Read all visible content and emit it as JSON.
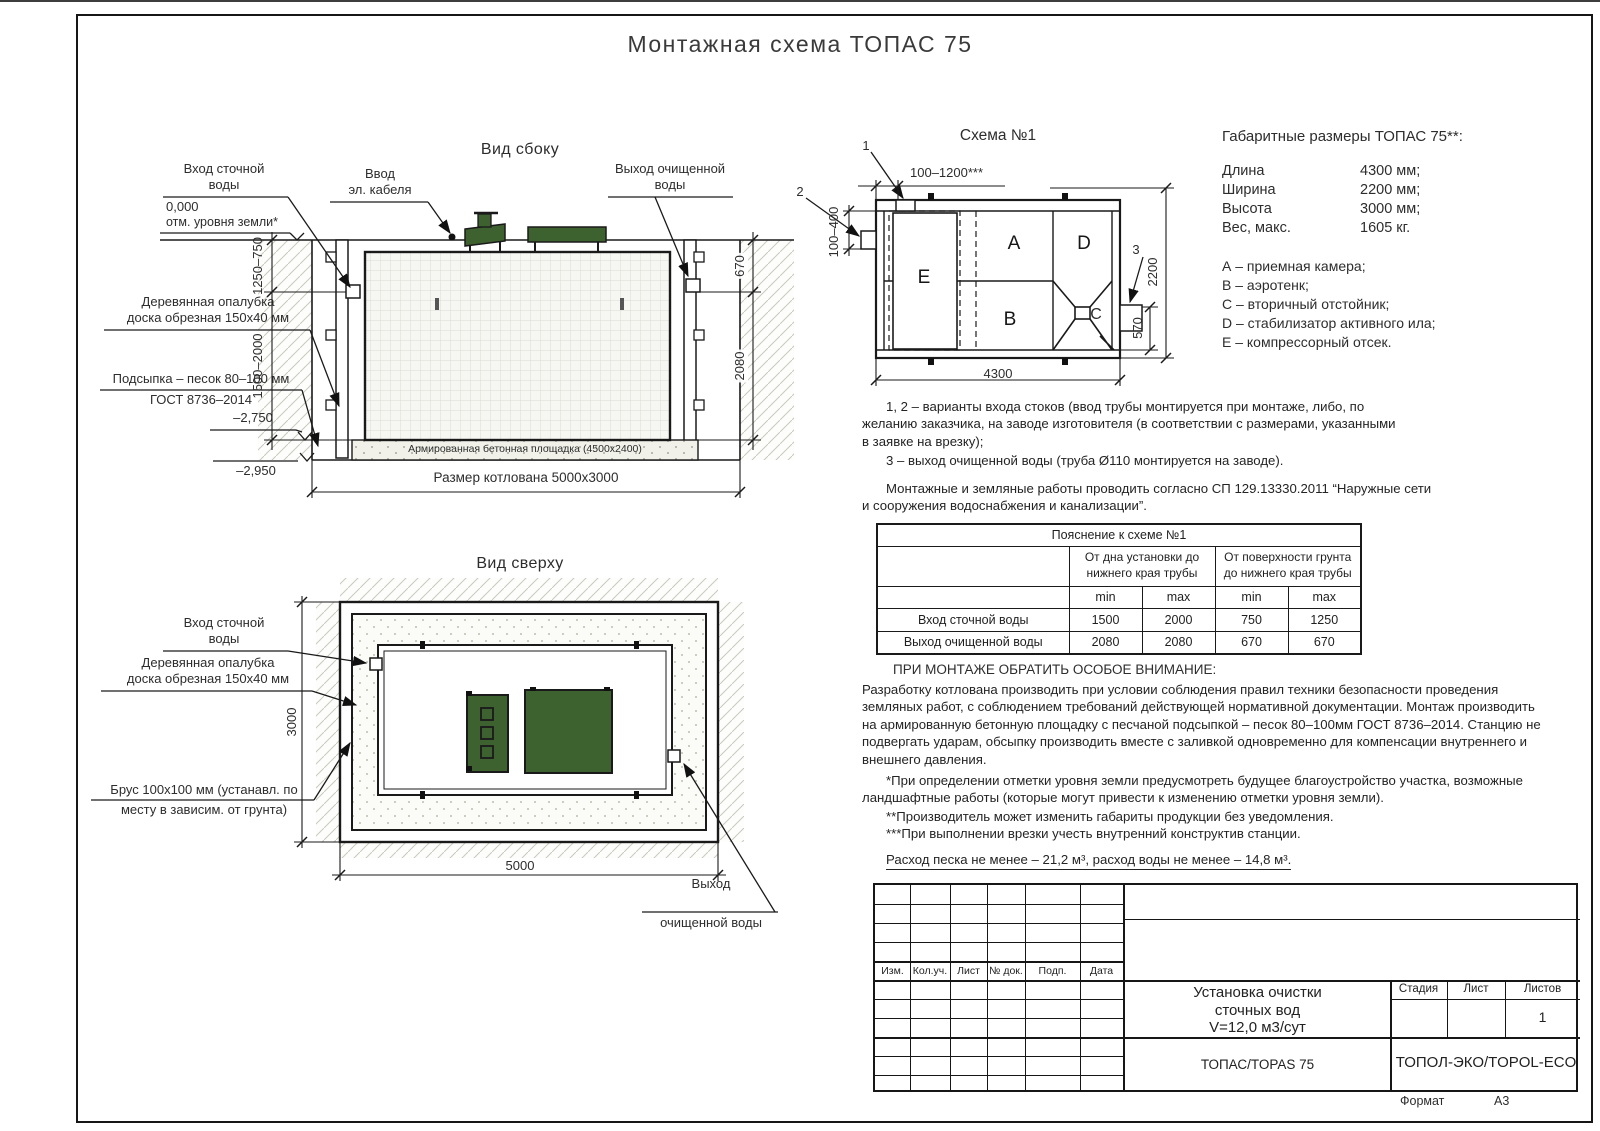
{
  "page": {
    "title": "Монтажная схема ТОПАС 75",
    "format_label": "Формат",
    "format_value": "А3"
  },
  "colors": {
    "lid_green": "#3e622f",
    "line": "#1a1a1a"
  },
  "side_view": {
    "title": "Вид сбоку",
    "label_inlet": "Вход сточной\nводы",
    "label_cable": "Ввод\nэл. кабеля",
    "label_outlet": "Выход очищенной\nводы",
    "level_zero": "0,000",
    "level_zero_note": "отм. уровня земли*",
    "label_formwork": "Деревянная опалубка\nдоска обрезная 150х40 мм",
    "label_sand_1": "Подсыпка – песок 80–100 мм",
    "label_sand_2": "ГОСТ 8736–2014",
    "level_minus1": "–2,750",
    "level_minus2": "–2,950",
    "label_slab": "Армированная бетонная площадка (4500х2400)",
    "dim_pit": "Размер котлована 5000х3000",
    "dim_left_top": "1250–750",
    "dim_left_bottom": "1500–2000",
    "dim_right_top": "670",
    "dim_right_bottom": "2080"
  },
  "top_view": {
    "title": "Вид сверху",
    "label_inlet": "Вход сточной\nводы",
    "label_formwork": "Деревянная опалубка\nдоска обрезная 150х40 мм",
    "label_timber_1": "Брус 100х100 мм (устанавл. по",
    "label_timber_2": "месту в зависим. от грунта)",
    "label_outlet_1": "Выход",
    "label_outlet_2": "очищенной воды",
    "dim_height": "3000",
    "dim_width": "5000"
  },
  "schema": {
    "title": "Схема №1",
    "callout_1": "1",
    "callout_2": "2",
    "callout_3": "3",
    "comp_a": "А",
    "comp_b": "В",
    "comp_c": "С",
    "comp_d": "D",
    "comp_e": "Е",
    "dim_top": "100–1200***",
    "dim_left": "100–400",
    "dim_right": "2200",
    "dim_outlet": "570",
    "dim_bottom": "4300"
  },
  "specs": {
    "title": "Габаритные размеры ТОПАС 75**:",
    "rows": [
      {
        "label": "Длина",
        "value": "4300 мм;"
      },
      {
        "label": "Ширина",
        "value": "2200 мм;"
      },
      {
        "label": "Высота",
        "value": "3000 мм;"
      },
      {
        "label": "Вес, макс.",
        "value": "1605 кг."
      }
    ],
    "legend": [
      "А – приемная камера;",
      "В – аэротенк;",
      "С – вторичный отстойник;",
      "D – стабилизатор активного ила;",
      "Е – компрессорный отсек."
    ]
  },
  "notes": {
    "variants": "1, 2 – варианты входа  стоков (ввод трубы монтируется при монтаже, либо, по\nжеланию заказчика, на заводе изготовителя (в соответствии с размерами, указанными\nв заявке на врезку);",
    "outlet": "3 – выход очищенной воды (труба Ø110 монтируется на заводе).",
    "sp": "Монтажные и земляные работы проводить согласно СП 129.13330.2011 “Наружные сети\nи сооружения водоснабжения и канализации”."
  },
  "explain_table": {
    "title": "Пояснение к схеме №1",
    "group1": "От дна установки до\nнижнего края трубы",
    "group2": "От поверхности грунта\nдо нижнего края трубы",
    "min": "min",
    "max": "max",
    "rows": [
      {
        "label": "Вход сточной воды",
        "v1": "1500",
        "v2": "2000",
        "v3": "750",
        "v4": "1250"
      },
      {
        "label": "Выход очищенной воды",
        "v1": "2080",
        "v2": "2080",
        "v3": "670",
        "v4": "670"
      }
    ]
  },
  "attention": {
    "title": "ПРИ МОНТАЖЕ ОБРАТИТЬ ОСОБОЕ ВНИМАНИЕ:",
    "body": "Разработку котлована производить при условии соблюдения правил техники безопасности проведения\nземляных работ, с соблюдением требований действующей нормативной документации.  Монтаж производить\nна армированную бетонную площадку с песчаной подсыпкой – песок 80–100мм ГОСТ 8736–2014. Станцию не\nподвергать ударам, обсыпку производить вместе с заливкой одновременно для компенсации внутреннего и\nвнешнего давления."
  },
  "footnotes": {
    "f1": "*При определении отметки уровня земли предусмотреть будущее благоустройство участка, возможные\nландшафтные работы (которые могут привести к изменению отметки уровня земли).",
    "f2": "**Производитель может изменить габариты продукции без уведомления.",
    "f3": "***При выполнении врезки учесть внутренний конструктив станции.",
    "consumption": "Расход песка не менее – 21,2 м³, расход воды не менее – 14,8 м³."
  },
  "stamp": {
    "rev": [
      "Изм.",
      "Кол.уч.",
      "Лист",
      "№ док.",
      "Подп.",
      "Дата"
    ],
    "doc_title": "Установка очистки\nсточных вод\nV=12,0 м3/сут",
    "stage": "Стадия",
    "sheet": "Лист",
    "sheets": "Листов",
    "sheets_value": "1",
    "product": "ТОПАС/TOPAS 75",
    "company": "ТОПОЛ-ЭКО/TOPOL-ECO"
  }
}
